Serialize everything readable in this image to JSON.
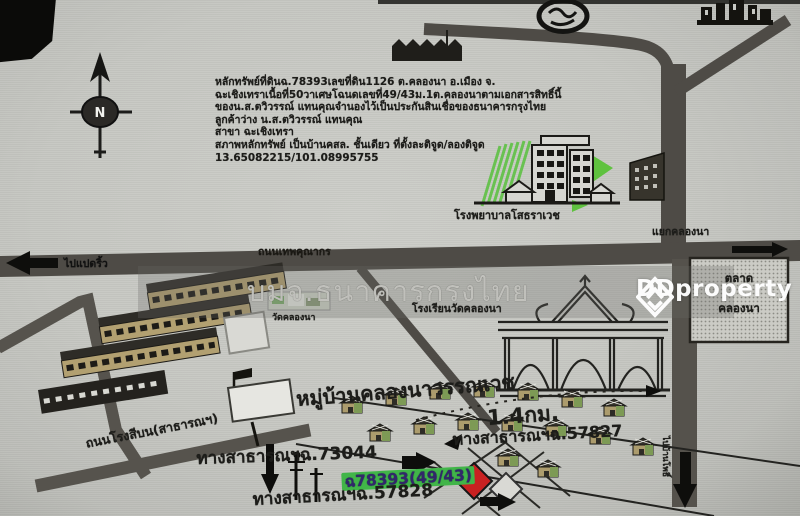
{
  "brand": {
    "watermark_logo_text": "DDproperty",
    "watermark_bank": "บมจ.ธนาคารกรุงไทย"
  },
  "compass": {
    "north": "N"
  },
  "header": {
    "lines": [
      "หลักทรัพย์ที่ดินฉ.78393เลขที่ดิน1126 ต.คลองนา อ.เมือง จ.",
      "ฉะเชิงเทราเนื้อที่50วาเศษโฉนดเลขที่49/43ม.1ต.คลองนาตามเอกสารสิทธิ์นี้",
      "ของน.ส.ตวิวรรณ์ แทนคุณจำนองไว้เป็นประกันสินเชื่อของธนาคารกรุงไทย",
      "ลูกค้าว่าง น.ส.ตวิวรรณ์ แทนคุณ",
      "สาขา ฉะเชิงเทรา",
      "สภาพหลักทรัพย์ เป็นบ้านคสล. ชั้นเดียว   ที่ตั้งละติจูด/ลองติจูด",
      "13.65082215/101.08995755"
    ]
  },
  "map": {
    "hospital_label": "โรงพยาบาลโสธราเวช",
    "junction_label": "แยกคลองนา",
    "main_road_label": "ถนนเทพคุณากร",
    "dir_west": "ไปแปดริ้ว",
    "dir_south": "ไปบ้านโพธิ์",
    "photo_caption": "วัดคลองนา",
    "school_label": "โรงเรียนวัดคลองนา",
    "market_label_line1": "ตลาด",
    "market_label_line2": "คลองนา",
    "village_name": "หมู่บ้านคลองนาวรรณเวช",
    "rongsi_road_label": "ถนนโรงสีบน(สาธารณฯ)",
    "distance": "1.4กม.",
    "public_way_57827": "ทางสาธารณฯฉ.57827",
    "public_way_73044": "ทางสาธารณฯฉ.73044",
    "deed_label": "ฉ78393(49/43)",
    "public_way_57828": "ทางสาธารณฯฉ.57828"
  },
  "colors": {
    "paper": "#c7c8c3",
    "road": "#4e4b46",
    "accent_green": "#41b549",
    "marker_red": "#c92121",
    "deco_green": "#58c13d"
  }
}
